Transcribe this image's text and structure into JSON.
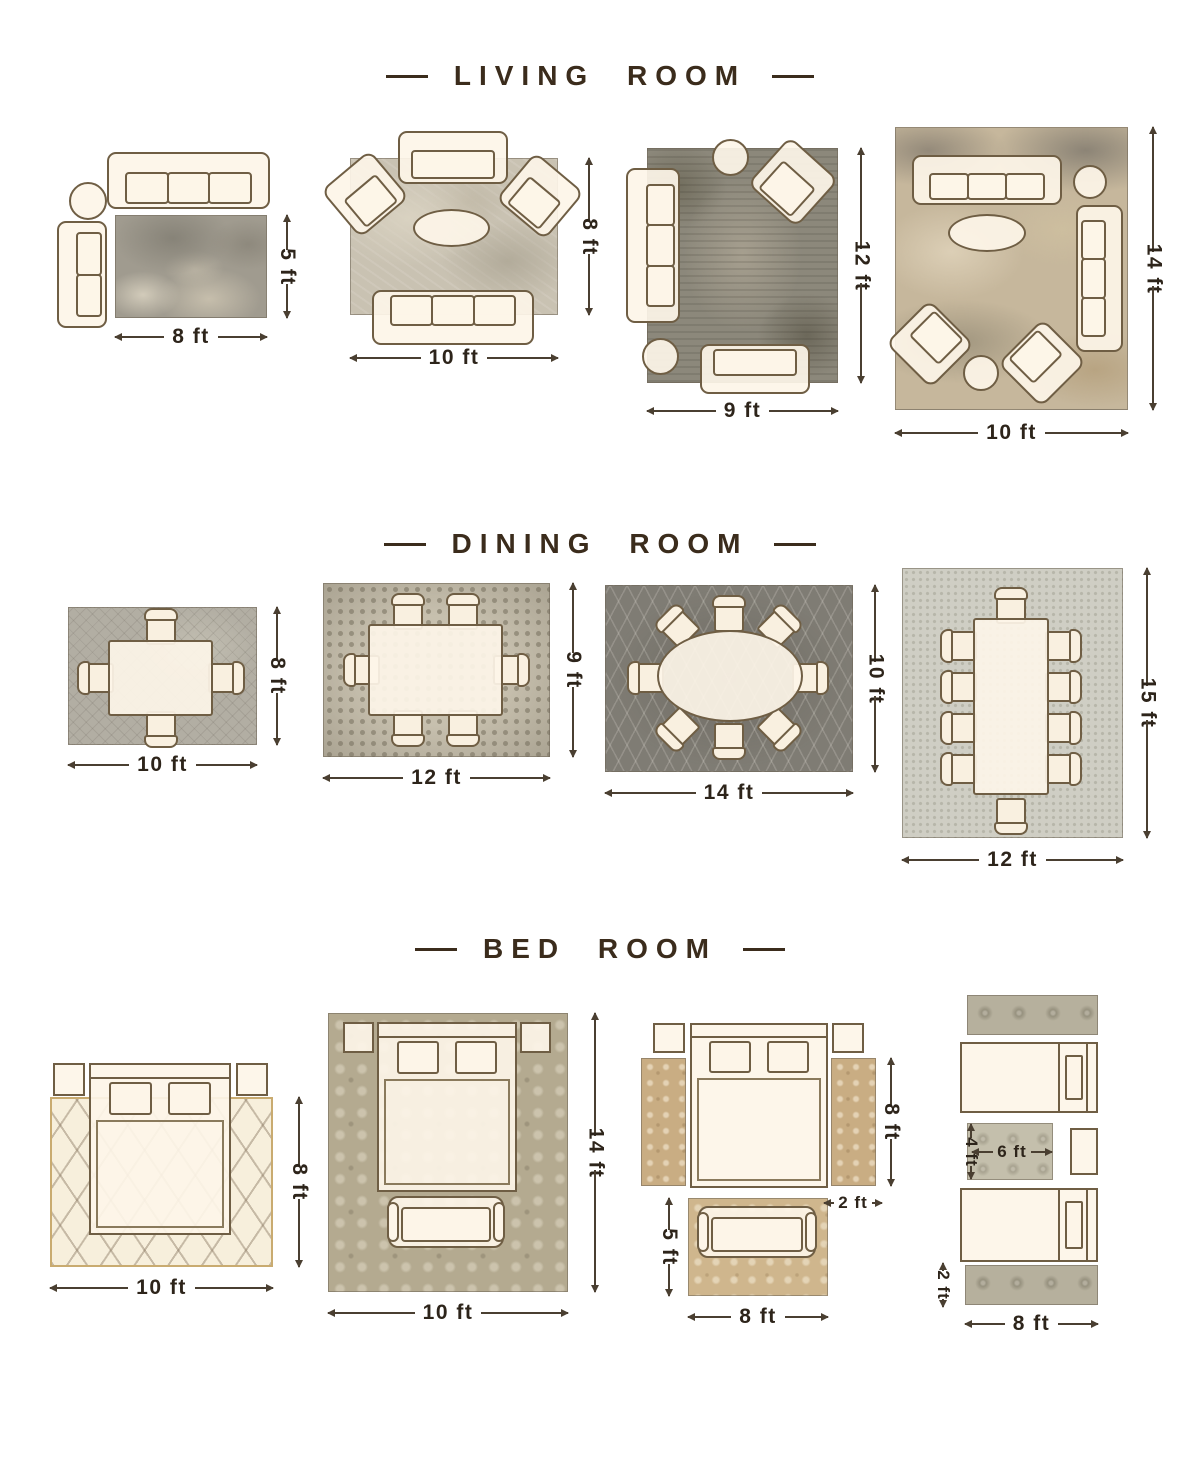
{
  "colors": {
    "background": "#ffffff",
    "title_text": "#3b2c1c",
    "dimension_text": "#2d241a",
    "furniture_outline": "#6f5e44",
    "furniture_fill": "#fdf5e8"
  },
  "sections": [
    {
      "id": "living-room",
      "title": "LIVING ROOM",
      "layouts": [
        {
          "labels": {
            "width": "8 ft",
            "height": "5 ft"
          }
        },
        {
          "labels": {
            "width": "10 ft",
            "height": "8 ft"
          }
        },
        {
          "labels": {
            "width": "9 ft",
            "height": "12 ft"
          }
        },
        {
          "labels": {
            "width": "10 ft",
            "height": "14 ft"
          }
        }
      ]
    },
    {
      "id": "dining-room",
      "title": "DINING ROOM",
      "layouts": [
        {
          "labels": {
            "width": "10 ft",
            "height": "8 ft"
          }
        },
        {
          "labels": {
            "width": "12 ft",
            "height": "9 ft"
          }
        },
        {
          "labels": {
            "width": "14 ft",
            "height": "10 ft"
          }
        },
        {
          "labels": {
            "width": "12 ft",
            "height": "15 ft"
          }
        }
      ]
    },
    {
      "id": "bed-room",
      "title": "BED ROOM",
      "layouts": [
        {
          "labels": {
            "width": "10 ft",
            "height": "8 ft"
          }
        },
        {
          "labels": {
            "width": "10 ft",
            "height": "14 ft"
          }
        },
        {
          "labels": {
            "side_height": "8 ft",
            "side_width": "2 ft",
            "foot_height": "5 ft",
            "foot_width": "8 ft"
          }
        },
        {
          "labels": {
            "accent_height": "4 ft",
            "accent_width": "6 ft",
            "runner_height": "2 ft",
            "width": "8 ft"
          }
        }
      ]
    }
  ]
}
